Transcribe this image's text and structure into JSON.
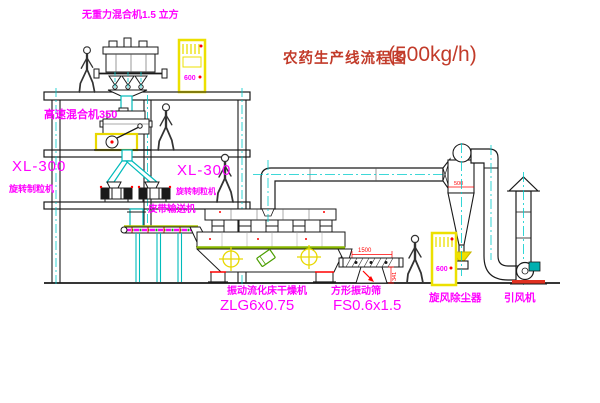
{
  "title": {
    "text": "农药生产线流程图",
    "capacity": "(500kg/h)"
  },
  "labels": {
    "top_mixer": "无重力混合机1.5 立方",
    "high_speed_mixer": "高速混合机350",
    "granulator_left_model": "XL-300",
    "granulator_left_name": "旋转制粒机",
    "granulator_right_model": "XL-300",
    "granulator_right_name": "旋转制粒机",
    "belt_conveyor": "皮带输送机",
    "dryer_name": "振动流化床干燥机",
    "dryer_model": "ZLG6x0.75",
    "sieve_name": "方形振动筛",
    "sieve_model": "FS0.6x1.5",
    "cyclone": "旋风除尘器",
    "fan": "引风机"
  },
  "dimensions": {
    "sieve_length": "1500",
    "sieve_stand_height": "341",
    "cyclone_dim": "500",
    "cabinet_text": "600"
  },
  "colors": {
    "label_magenta": "#ff00ff",
    "title_red": "#c23b2a",
    "dimension_red": "#ff0000",
    "centerline_cyan": "#00cccc",
    "chute_cyan": "#00bbbb",
    "highlight_yellow": "#e8d800",
    "stripe_green": "#8ab800",
    "motor_teal": "#00b0b0",
    "line_black": "#1a1a1a"
  }
}
